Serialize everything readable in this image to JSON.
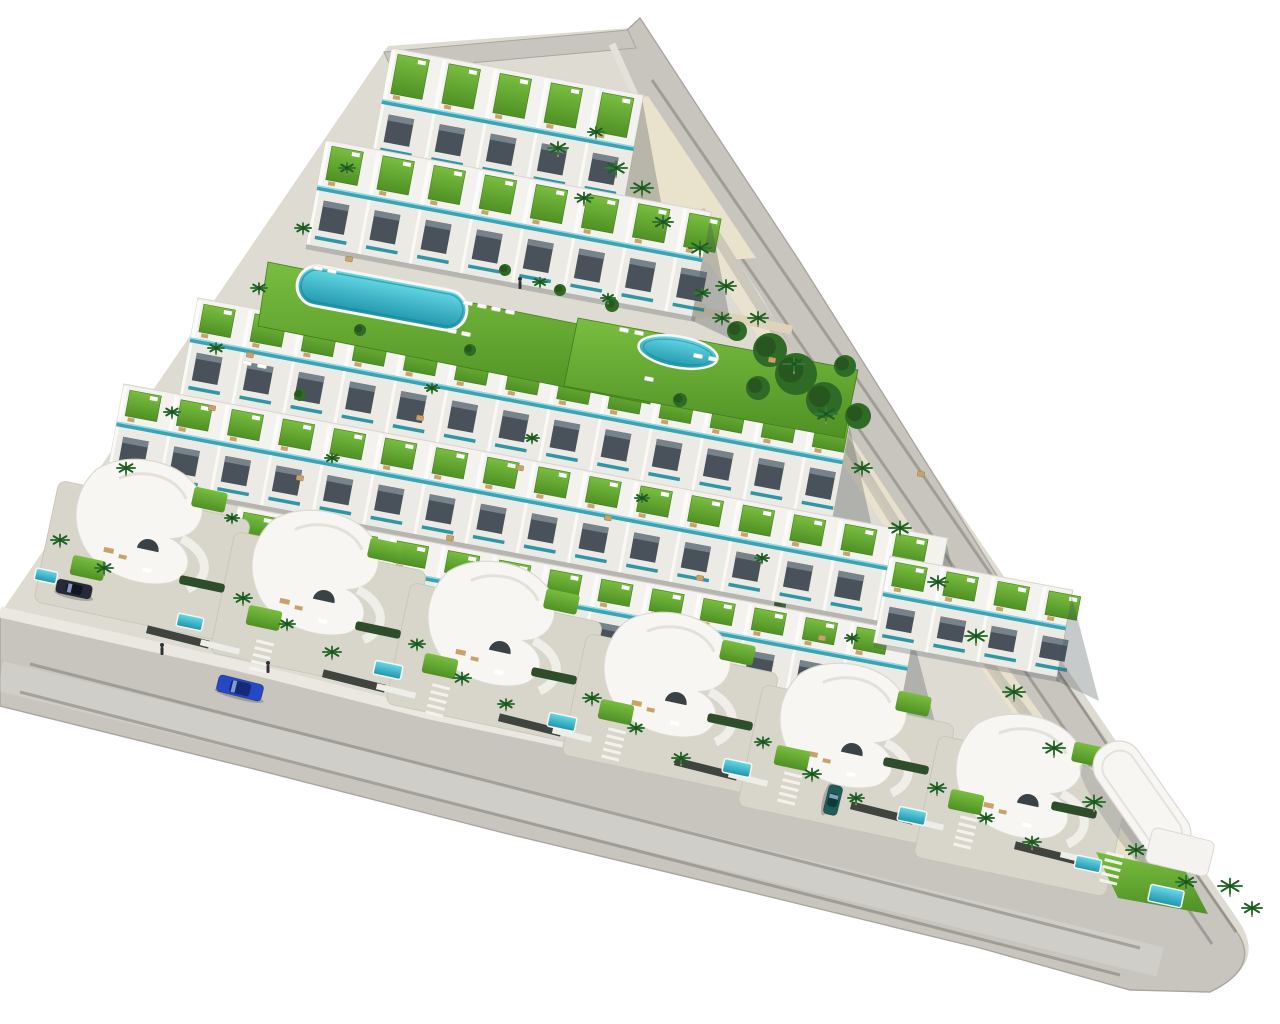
{
  "meta": {
    "alt": "Aerial 3D architectural render of a triangular coastal residential development with terraced white townhouses, green roof terraces, communal pools, curved villas, palm trees and perimeter roads"
  },
  "canvas": {
    "width": 1280,
    "height": 1024,
    "background": "#ffffff"
  },
  "palette": {
    "road": "#c8c5be",
    "roadEdge": "#a9a69e",
    "curb": "#eae8e1",
    "site": "#dedbd3",
    "building": "#f3f2ee",
    "buildingEdge": "#d7d5cd",
    "facade": "#eceae4",
    "window": "#49525a",
    "glass": "#76838b",
    "teal": "#3aa4b4",
    "teal2": "#2f96a6",
    "tealHi": "#8fdce4",
    "lawnTop": "#79bd40",
    "lawnBot": "#4f9124",
    "lawnEdge": "#447c1e",
    "poolTop": "#67dbe7",
    "poolBot": "#1f93aa",
    "poolRim": "#f7f6f2",
    "poolInner": "#157f95",
    "sand": "#e9e2cd",
    "walk": "#ded3b8",
    "patio": "#d8d5ca",
    "palm": "#2f7a33",
    "palmDark": "#225c26",
    "trunk": "#9b8a67",
    "tree": "#2f6a26",
    "treeDark": "#234f1c",
    "hedge": "#2e4d2a",
    "wallDark": "#3f443e",
    "wallWhite": "#eeeee9",
    "furnTan": "#c7a26a",
    "furnTanEdge": "#a87f4b",
    "furnWhite": "#fdfdfb",
    "person": "#2e3338",
    "shadow": "rgba(70,78,84,0.30)"
  },
  "angles": {
    "row": 10.6,
    "villa": 12,
    "drive": 104,
    "lounger": 11
  },
  "rowUnit": 52,
  "paths": {
    "site": "M 388,46 L 630,28 L 1238,920 Q 1262,955 1232,978 L 1202,993 L 0,704 L 0,614 Z",
    "road": "M 640,18 L 700,110 L 800,262 L 902,424 L 1012,600 L 1124,772 L 1234,928 Q 1264,966 1210,992 L 1130,990 L 980,948 L 750,892 L 500,832 L 250,768 L 0,706 L 0,616 L 240,670 L 430,718 L 620,758 L 860,810 L 1060,858 Q 1150,886 1118,846 L 1028,726 L 928,586 L 836,432 L 758,298 L 658,146 L 612,44 Z",
    "stub": "M 384,52 L 628,30 L 636,48 L 392,70 Z",
    "sidewalkBottom": "0,612 240,666 430,714 620,754 860,806 1060,854 1150,880",
    "sidewalkRight": "612,44 658,146 758,298 836,432 928,586 1028,726 1118,846 1150,876",
    "apexSand": "520,120 648,96 756,258 700,262 560,250",
    "cornerLawn": "1096,852 1186,872 1208,914 1118,898",
    "lawn1": "268,262 658,340 650,404 258,326",
    "lawn2": "578,318 858,370 844,438 564,386",
    "wearRight1": "652,80 1236,932",
    "wearRight2": "628,92 1212,944",
    "wearBottom1": "30,664 1140,948",
    "wearBottom2": "20,692 1120,975",
    "centerBandBottom": "0,676 1160,962",
    "innerShade": "700,210 800,370 900,530 1000,680 1090,800",
    "sandStrip": "660,170 760,320 860,470 960,620 1060,760 1130,860",
    "walkway1": "447,262 705,312",
    "walkway2": "705,312 792,330"
  },
  "rows": [
    {
      "x": 392,
      "y": 48,
      "len": 256,
      "roof": 54,
      "face": 56,
      "layer": 1
    },
    {
      "x": 326,
      "y": 140,
      "len": 392,
      "roof": 48,
      "face": 58,
      "layer": 1
    },
    {
      "x": 198,
      "y": 298,
      "len": 664,
      "roof": 42,
      "face": 56,
      "layer": 1
    },
    {
      "x": 124,
      "y": 384,
      "len": 838,
      "roof": 40,
      "face": 54,
      "layer": 2
    },
    {
      "x": 238,
      "y": 506,
      "len": 688,
      "roof": 36,
      "face": 52,
      "layer": 2
    },
    {
      "x": 890,
      "y": 556,
      "len": 186,
      "roof": 38,
      "face": 50,
      "layer": 2
    }
  ],
  "bigPool": {
    "cx": 382,
    "cy": 298,
    "len": 172,
    "h": 40,
    "rot": 10.5
  },
  "ovalPool": {
    "cx": 678,
    "cy": 352,
    "rx": 40,
    "ry": 15.5,
    "rot": 10
  },
  "yardPools": [
    [
      46,
      576,
      22,
      12
    ],
    [
      190,
      622,
      26,
      13
    ],
    [
      388,
      670,
      28,
      14
    ],
    [
      562,
      722,
      28,
      14
    ],
    [
      737,
      768,
      28,
      14
    ],
    [
      912,
      816,
      28,
      14
    ],
    [
      1088,
      864,
      26,
      13
    ],
    [
      1166,
      896,
      34,
      17
    ]
  ],
  "villas": [
    [
      142,
      514
    ],
    [
      318,
      565
    ],
    [
      494,
      616
    ],
    [
      670,
      667
    ],
    [
      846,
      718
    ],
    [
      1022,
      769
    ]
  ],
  "cornerBuilding": {
    "x": 1142,
    "y": 800,
    "rot": 55,
    "w": 132,
    "h": 50,
    "wingX": 1180,
    "wingY": 852,
    "wingRot": 14,
    "wingW": 64,
    "wingH": 36
  },
  "trees": [
    [
      770,
      350,
      17
    ],
    [
      796,
      374,
      21
    ],
    [
      824,
      400,
      18
    ],
    [
      758,
      388,
      12
    ],
    [
      845,
      366,
      11
    ],
    [
      858,
      416,
      13
    ],
    [
      737,
      331,
      10
    ],
    [
      612,
      305,
      7
    ],
    [
      560,
      290,
      6
    ],
    [
      505,
      270,
      6
    ],
    [
      680,
      400,
      7
    ],
    [
      470,
      350,
      6
    ],
    [
      360,
      330,
      6
    ],
    [
      300,
      395,
      6
    ],
    [
      430,
      455,
      6
    ],
    [
      540,
      505,
      6
    ],
    [
      660,
      555,
      6
    ],
    [
      780,
      605,
      6
    ],
    [
      240,
      445,
      6
    ],
    [
      180,
      505,
      6
    ],
    [
      120,
      560,
      6
    ],
    [
      900,
      660,
      7
    ],
    [
      1010,
      720,
      6
    ]
  ],
  "palms": [
    [
      558,
      148,
      10
    ],
    [
      596,
      132,
      8
    ],
    [
      616,
      168,
      11
    ],
    [
      584,
      198,
      9
    ],
    [
      642,
      188,
      11
    ],
    [
      663,
      222,
      10
    ],
    [
      700,
      248,
      11
    ],
    [
      726,
      286,
      10
    ],
    [
      758,
      318,
      10
    ],
    [
      794,
      364,
      11
    ],
    [
      826,
      414,
      11
    ],
    [
      862,
      468,
      10
    ],
    [
      900,
      528,
      11
    ],
    [
      938,
      582,
      10
    ],
    [
      976,
      636,
      11
    ],
    [
      1014,
      692,
      11
    ],
    [
      1054,
      748,
      11
    ],
    [
      1094,
      802,
      11
    ],
    [
      1136,
      850,
      10
    ],
    [
      1186,
      882,
      10
    ],
    [
      1230,
      886,
      12
    ],
    [
      1252,
      908,
      10
    ],
    [
      347,
      168,
      8
    ],
    [
      303,
      228,
      8
    ],
    [
      259,
      288,
      8
    ],
    [
      216,
      348,
      8
    ],
    [
      172,
      412,
      8
    ],
    [
      126,
      468,
      9
    ],
    [
      60,
      540,
      9
    ],
    [
      104,
      568,
      9
    ],
    [
      243,
      598,
      9
    ],
    [
      287,
      624,
      8
    ],
    [
      332,
      652,
      9
    ],
    [
      417,
      644,
      8
    ],
    [
      462,
      678,
      9
    ],
    [
      506,
      704,
      8
    ],
    [
      592,
      698,
      9
    ],
    [
      636,
      728,
      8
    ],
    [
      681,
      758,
      9
    ],
    [
      763,
      742,
      8
    ],
    [
      812,
      774,
      9
    ],
    [
      856,
      798,
      8
    ],
    [
      937,
      788,
      9
    ],
    [
      986,
      818,
      8
    ],
    [
      1032,
      842,
      9
    ],
    [
      702,
      293,
      8
    ],
    [
      722,
      318,
      9
    ],
    [
      608,
      298,
      7
    ],
    [
      540,
      282,
      7
    ],
    [
      432,
      388,
      7
    ],
    [
      332,
      458,
      7
    ],
    [
      532,
      438,
      7
    ],
    [
      642,
      498,
      7
    ],
    [
      232,
      518,
      7
    ],
    [
      762,
      558,
      7
    ],
    [
      852,
      638,
      7
    ]
  ],
  "loungers": [
    [
      468,
      303
    ],
    [
      482,
      306
    ],
    [
      496,
      309
    ],
    [
      510,
      312
    ],
    [
      452,
      331
    ],
    [
      466,
      334
    ],
    [
      318,
      268
    ],
    [
      332,
      271
    ],
    [
      624,
      330
    ],
    [
      639,
      333
    ],
    [
      698,
      356
    ],
    [
      713,
      359
    ],
    [
      649,
      379
    ],
    [
      1134,
      868
    ],
    [
      1148,
      872
    ],
    [
      247,
      363
    ],
    [
      262,
      366
    ]
  ],
  "tables": [
    [
      349,
      259
    ],
    [
      772,
      360
    ],
    [
      921,
      474
    ],
    [
      250,
      355
    ],
    [
      420,
      418
    ],
    [
      300,
      478
    ],
    [
      520,
      468
    ],
    [
      608,
      518
    ],
    [
      450,
      538
    ],
    [
      700,
      578
    ],
    [
      822,
      638
    ],
    [
      896,
      698
    ],
    [
      1002,
      758
    ],
    [
      563,
      620
    ],
    [
      388,
      585
    ],
    [
      736,
      672
    ],
    [
      212,
      408
    ]
  ],
  "stripes": [
    [
      262,
      655
    ],
    [
      438,
      699
    ],
    [
      614,
      743
    ],
    [
      790,
      787
    ],
    [
      966,
      831
    ],
    [
      1112,
      867
    ]
  ],
  "wallsDark": [
    [
      178,
      637
    ],
    [
      354,
      681
    ],
    [
      530,
      725
    ],
    [
      706,
      769
    ],
    [
      882,
      813
    ],
    [
      1046,
      853
    ]
  ],
  "wallsWhite": [
    [
      220,
      647
    ],
    [
      396,
      691
    ],
    [
      572,
      735
    ],
    [
      748,
      779
    ],
    [
      924,
      823
    ],
    [
      1080,
      859
    ]
  ],
  "hedges": [
    [
      202,
      584
    ],
    [
      378,
      630
    ],
    [
      554,
      676
    ],
    [
      730,
      722
    ],
    [
      906,
      766
    ],
    [
      1074,
      810
    ]
  ],
  "yardLawns": [
    [
      88,
      568
    ],
    [
      264,
      618
    ],
    [
      440,
      666
    ],
    [
      616,
      712
    ],
    [
      792,
      758
    ],
    [
      966,
      802
    ]
  ],
  "cars": [
    {
      "x": 240,
      "y": 688,
      "rot": 14,
      "len": 46,
      "w": 17,
      "body": "#2448c6",
      "cabin": "#142a7a",
      "name": "car-blue-driving"
    },
    {
      "x": 74,
      "y": 589,
      "rot": 12,
      "len": 36,
      "w": 14,
      "body": "#232b38",
      "cabin": "#11161f",
      "name": "car-dark-parked"
    },
    {
      "x": 833,
      "y": 800,
      "rot": 104,
      "len": 30,
      "w": 14,
      "body": "#1e5e58",
      "cabin": "#0f3b37",
      "name": "car-teal-parked"
    }
  ],
  "people": [
    [
      268,
      667
    ],
    [
      162,
      649
    ],
    [
      520,
      283
    ]
  ]
}
